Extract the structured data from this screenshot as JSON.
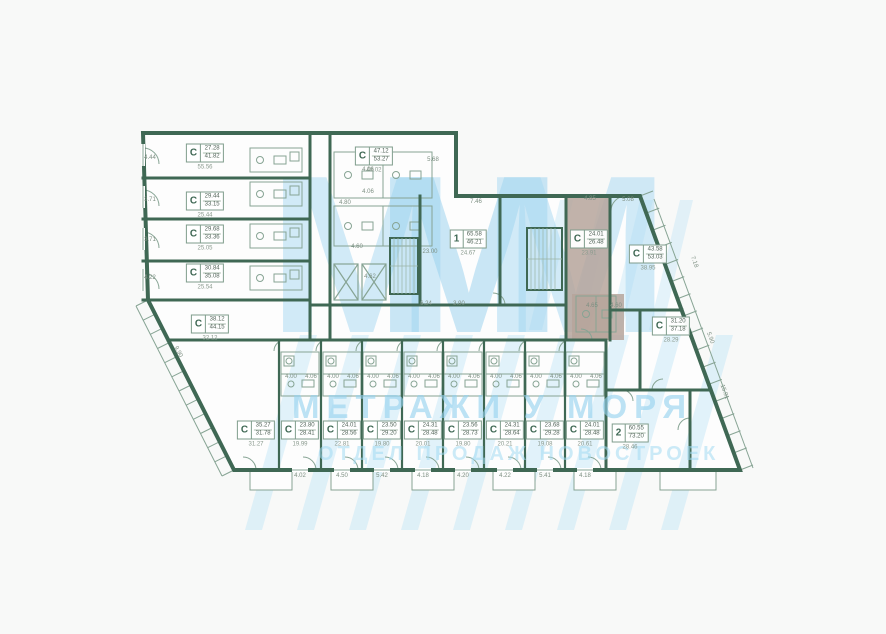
{
  "watermark": {
    "logo_letter": "М",
    "line1": "МЕТРАЖИ У МОРЯ",
    "line2": "ОТДЕЛ ПРОДАЖ НОВОСТРОЕК"
  },
  "colors": {
    "wall": "#3f6854",
    "thin_line": "#87a494",
    "highlight": "#b6a59b",
    "watermark_blue": "#bfe2f3",
    "background": "#f8f9f8",
    "plan_fill": "#fdfdfd"
  },
  "units": [
    {
      "type": "С",
      "area_top": "27.28",
      "area_bottom": "41.82",
      "area_below": "55.56",
      "x": 205,
      "y": 157,
      "selected": false
    },
    {
      "type": "С",
      "area_top": "29.44",
      "area_bottom": "33.15",
      "area_below": "25.44",
      "x": 205,
      "y": 205,
      "selected": false
    },
    {
      "type": "С",
      "area_top": "29.68",
      "area_bottom": "33.36",
      "area_below": "25.05",
      "x": 205,
      "y": 238,
      "selected": false
    },
    {
      "type": "С",
      "area_top": "30.84",
      "area_bottom": "35.08",
      "area_below": "25.54",
      "x": 205,
      "y": 277,
      "selected": false
    },
    {
      "type": "С",
      "area_top": "38.12",
      "area_bottom": "44.15",
      "area_below": "32.12",
      "x": 210,
      "y": 328,
      "selected": false
    },
    {
      "type": "С",
      "area_top": "47.12",
      "area_bottom": "53.27",
      "area_below": "48.02",
      "x": 374,
      "y": 160,
      "selected": false
    },
    {
      "type": "1",
      "area_top": "65.58",
      "area_bottom": "46.21",
      "area_below": "24.67",
      "x": 468,
      "y": 243,
      "selected": false
    },
    {
      "type": "С",
      "area_top": "24.01",
      "area_bottom": "26.48",
      "area_below": "23.91",
      "x": 589,
      "y": 243,
      "selected": true
    },
    {
      "type": "С",
      "area_top": "43.58",
      "area_bottom": "53.03",
      "area_below": "38.95",
      "x": 648,
      "y": 258,
      "selected": false
    },
    {
      "type": "С",
      "area_top": "31.20",
      "area_bottom": "37.18",
      "area_below": "28.29",
      "x": 671,
      "y": 330,
      "selected": false
    },
    {
      "type": "2",
      "area_top": "60.55",
      "area_bottom": "73.20",
      "area_below": "28.46",
      "x": 630,
      "y": 437,
      "selected": false
    },
    {
      "type": "С",
      "area_top": "35.27",
      "area_bottom": "31.78",
      "area_below": "31.27",
      "x": 256,
      "y": 434,
      "selected": false
    },
    {
      "type": "С",
      "area_top": "23.80",
      "area_bottom": "28.41",
      "area_below": "19.99",
      "x": 300,
      "y": 434,
      "selected": false
    },
    {
      "type": "С",
      "area_top": "24.01",
      "area_bottom": "28.56",
      "area_below": "22.81",
      "x": 342,
      "y": 434,
      "selected": false
    },
    {
      "type": "С",
      "area_top": "23.50",
      "area_bottom": "29.20",
      "area_below": "19.80",
      "x": 382,
      "y": 434,
      "selected": false
    },
    {
      "type": "С",
      "area_top": "24.31",
      "area_bottom": "28.48",
      "area_below": "20.01",
      "x": 423,
      "y": 434,
      "selected": false
    },
    {
      "type": "С",
      "area_top": "23.56",
      "area_bottom": "28.73",
      "area_below": "19.80",
      "x": 463,
      "y": 434,
      "selected": false
    },
    {
      "type": "С",
      "area_top": "24.31",
      "area_bottom": "28.64",
      "area_below": "20.21",
      "x": 505,
      "y": 434,
      "selected": false
    },
    {
      "type": "С",
      "area_top": "23.68",
      "area_bottom": "29.28",
      "area_below": "19.08",
      "x": 545,
      "y": 434,
      "selected": false
    },
    {
      "type": "С",
      "area_top": "24.01",
      "area_bottom": "28.48",
      "area_below": "20.61",
      "x": 585,
      "y": 434,
      "selected": false
    }
  ],
  "dimensions": [
    {
      "t": "4.44",
      "x": 150,
      "y": 158
    },
    {
      "t": "3.71",
      "x": 150,
      "y": 200
    },
    {
      "t": "3.71",
      "x": 150,
      "y": 240
    },
    {
      "t": "4.22",
      "x": 150,
      "y": 278
    },
    {
      "t": "9.90",
      "x": 178,
      "y": 352,
      "r": 62
    },
    {
      "t": "5.68",
      "x": 433,
      "y": 160
    },
    {
      "t": "4.80",
      "x": 345,
      "y": 203
    },
    {
      "t": "4.06",
      "x": 368,
      "y": 170
    },
    {
      "t": "4.06",
      "x": 368,
      "y": 192
    },
    {
      "t": "4.60",
      "x": 357,
      "y": 247
    },
    {
      "t": "4.62",
      "x": 370,
      "y": 277
    },
    {
      "t": "7.46",
      "x": 476,
      "y": 202
    },
    {
      "t": "23.00",
      "x": 430,
      "y": 252
    },
    {
      "t": "6.24",
      "x": 426,
      "y": 304
    },
    {
      "t": "3.90",
      "x": 459,
      "y": 304
    },
    {
      "t": "4.85",
      "x": 590,
      "y": 199
    },
    {
      "t": "5.08",
      "x": 628,
      "y": 200
    },
    {
      "t": "7.18",
      "x": 694,
      "y": 262,
      "r": 70
    },
    {
      "t": "5.90",
      "x": 710,
      "y": 338,
      "r": 70
    },
    {
      "t": "15.91",
      "x": 724,
      "y": 392,
      "r": 70
    },
    {
      "t": "4.65",
      "x": 592,
      "y": 306
    },
    {
      "t": "4.60",
      "x": 616,
      "y": 306
    },
    {
      "t": "4.02",
      "x": 300,
      "y": 476
    },
    {
      "t": "4.50",
      "x": 342,
      "y": 476
    },
    {
      "t": "5.42",
      "x": 382,
      "y": 476
    },
    {
      "t": "4.18",
      "x": 423,
      "y": 476
    },
    {
      "t": "4.20",
      "x": 463,
      "y": 476
    },
    {
      "t": "4.22",
      "x": 505,
      "y": 476
    },
    {
      "t": "5.41",
      "x": 545,
      "y": 476
    },
    {
      "t": "4.18",
      "x": 585,
      "y": 476
    },
    {
      "t": "4.00",
      "x": 291,
      "y": 377
    },
    {
      "t": "4.06",
      "x": 311,
      "y": 377
    },
    {
      "t": "4.00",
      "x": 333,
      "y": 377
    },
    {
      "t": "4.06",
      "x": 353,
      "y": 377
    },
    {
      "t": "4.00",
      "x": 373,
      "y": 377
    },
    {
      "t": "4.06",
      "x": 393,
      "y": 377
    },
    {
      "t": "4.00",
      "x": 414,
      "y": 377
    },
    {
      "t": "4.06",
      "x": 434,
      "y": 377
    },
    {
      "t": "4.00",
      "x": 454,
      "y": 377
    },
    {
      "t": "4.06",
      "x": 474,
      "y": 377
    },
    {
      "t": "4.00",
      "x": 496,
      "y": 377
    },
    {
      "t": "4.06",
      "x": 516,
      "y": 377
    },
    {
      "t": "4.00",
      "x": 536,
      "y": 377
    },
    {
      "t": "4.06",
      "x": 556,
      "y": 377
    },
    {
      "t": "4.00",
      "x": 576,
      "y": 377
    },
    {
      "t": "4.06",
      "x": 596,
      "y": 377
    }
  ]
}
